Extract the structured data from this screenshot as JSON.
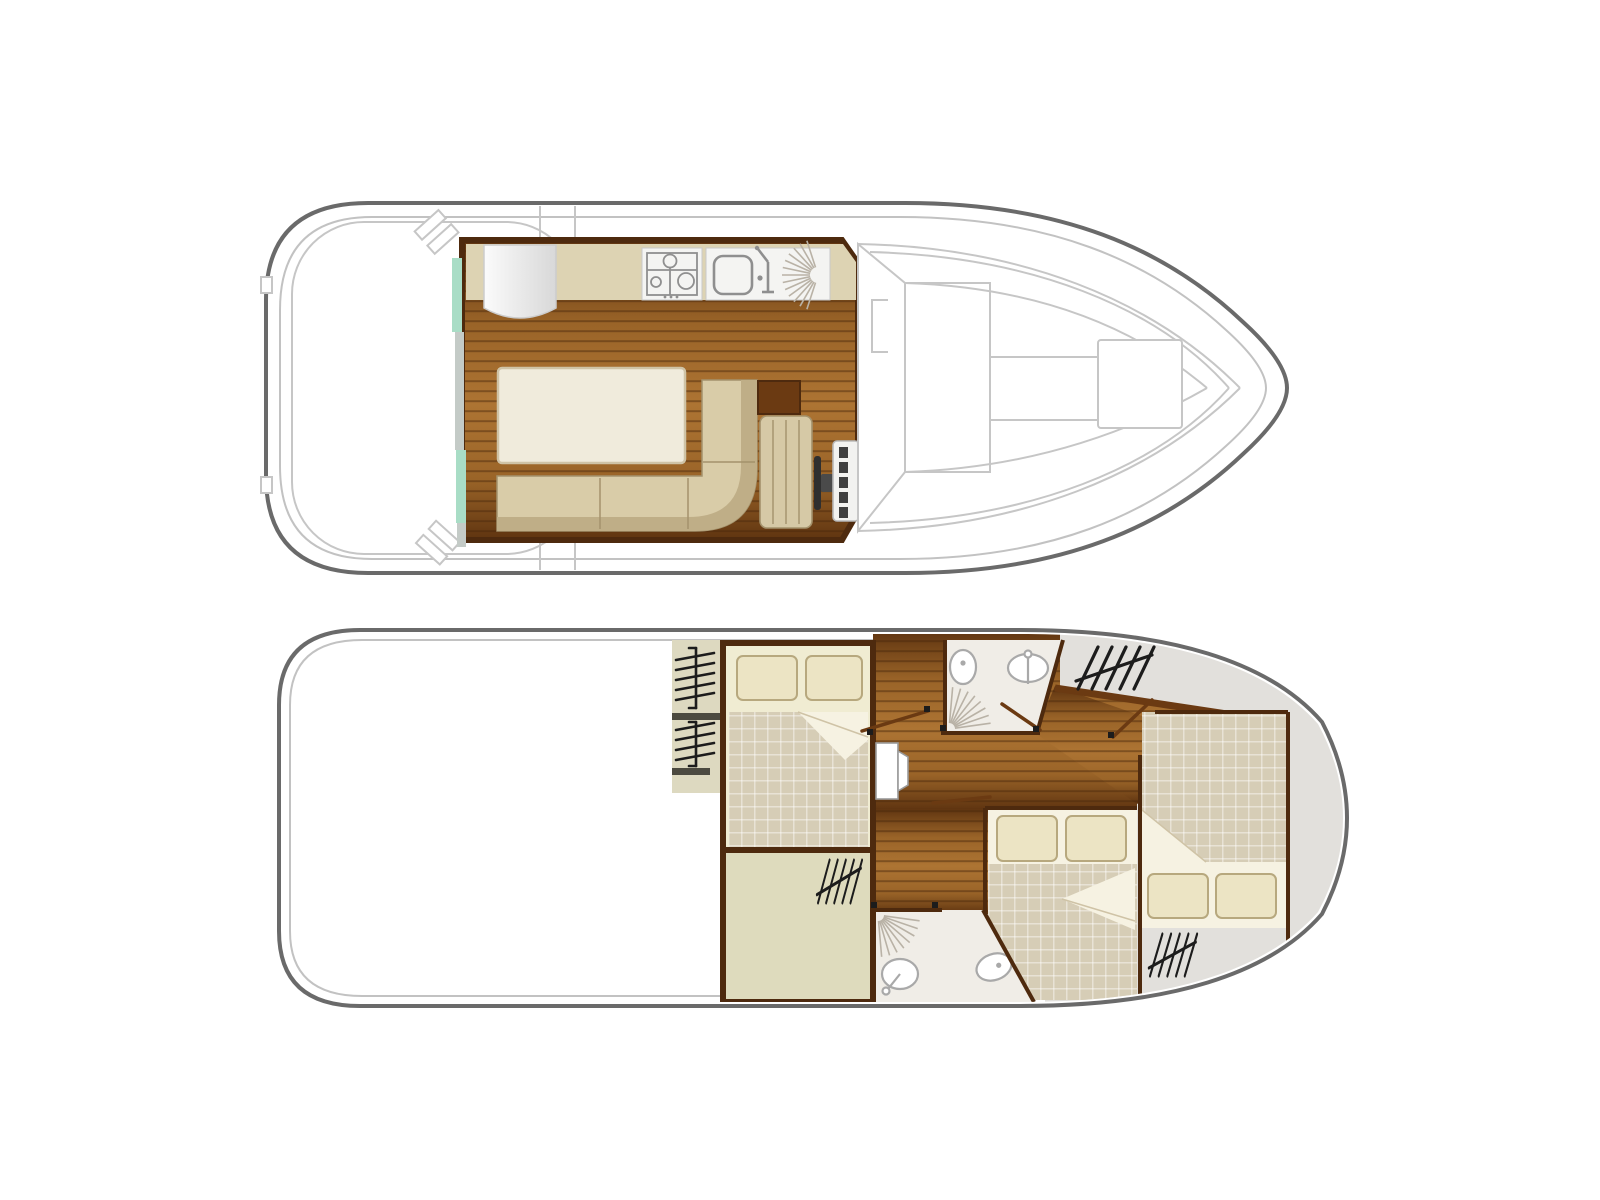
{
  "document": {
    "title": "Boat two-deck floor plan diagram",
    "background": "#ffffff"
  },
  "palette": {
    "white": "#ffffff",
    "hullLine": "#6a6a6a",
    "hullInner": "#c2c2c2",
    "deckLine": "#c6c6c6",
    "wall": "#4e2a0e",
    "woodDark": "#5f3410",
    "woodMid": "#9a6428",
    "woodLight": "#ad7433",
    "plankSeam": "#46250a",
    "counter": "#ddd3b3",
    "appliancePanel": "#f4f4f2",
    "applianceLine": "#8f8f8f",
    "bench": "#d9cca8",
    "benchShadow": "#bfae87",
    "benchLine": "#a4926c",
    "table": "#f0ebdc",
    "tableLine": "#cfc3a6",
    "teal": "#a9ddc6",
    "doorTrack": "#c4cbc7",
    "seat": "#d6c9a6",
    "wheel": "#2f2f2f",
    "panel": "#f2f2f0",
    "panelBtn": "#3f3f3f",
    "linen": "#f0ecd2",
    "sheet": "#f6f2e2",
    "duvet": "#d6cdb6",
    "pillow": "#ece4c4",
    "pillowLine": "#b7a87e",
    "greenFloor": "#dedbbd",
    "grayFloor": "#e2e0dc",
    "bathFloor": "#f0ede7",
    "fixture": "#a9a9a9",
    "stepsBg": "#ddd9c0",
    "stepBar": "#4c4a40",
    "hatch": "#1c1c1c",
    "doorLeaf": "#6b3a12",
    "fanLine": "#b9b2a6",
    "fridgeHi": "#fbfbfb",
    "fridgeLo": "#d8d8d8"
  },
  "decks": {
    "upper": {
      "name": "Upper deck plan",
      "rooms": [
        {
          "id": "aft-deck",
          "label": "Aft deck",
          "features": [
            "mooring-cleat",
            "mooring-cleat"
          ]
        },
        {
          "id": "saloon",
          "label": "Saloon",
          "features": [
            "dining-table",
            "l-shaped-bench",
            "sliding-door"
          ]
        },
        {
          "id": "galley",
          "label": "Galley",
          "features": [
            "refrigerator",
            "stove-4-burner",
            "sink-with-faucet",
            "dish-drainer"
          ]
        },
        {
          "id": "helm",
          "label": "Inside helm station",
          "features": [
            "helm-seat",
            "steering-wheel",
            "instrument-panel",
            "cabinet"
          ]
        },
        {
          "id": "bow-deck",
          "label": "Bow deck",
          "features": [
            "windshield",
            "roof-hatch"
          ]
        }
      ]
    },
    "lower": {
      "name": "Lower deck plan",
      "rooms": [
        {
          "id": "companionway",
          "label": "Companionway steps",
          "features": [
            "steps",
            "steps"
          ]
        },
        {
          "id": "aft-cabin",
          "label": "Aft double cabin",
          "features": [
            "double-bed",
            "pillow",
            "pillow"
          ]
        },
        {
          "id": "aft-storage",
          "label": "Storage room with wardrobe",
          "features": [
            "wardrobe"
          ]
        },
        {
          "id": "corridor",
          "label": "Corridor",
          "features": [
            "cabin-door"
          ]
        },
        {
          "id": "shower-room-1",
          "label": "Shower room with WC (forward)",
          "features": [
            "toilet",
            "washbasin",
            "shower"
          ]
        },
        {
          "id": "shower-room-2",
          "label": "Shower room with WC (aft)",
          "features": [
            "shower",
            "washbasin",
            "toilet"
          ]
        },
        {
          "id": "mid-cabin",
          "label": "Midship double cabin",
          "features": [
            "double-bed",
            "pillow",
            "pillow"
          ]
        },
        {
          "id": "bow-cabin",
          "label": "Bow double cabin",
          "features": [
            "double-bed",
            "pillow",
            "pillow",
            "wardrobe",
            "steps"
          ]
        }
      ]
    }
  }
}
